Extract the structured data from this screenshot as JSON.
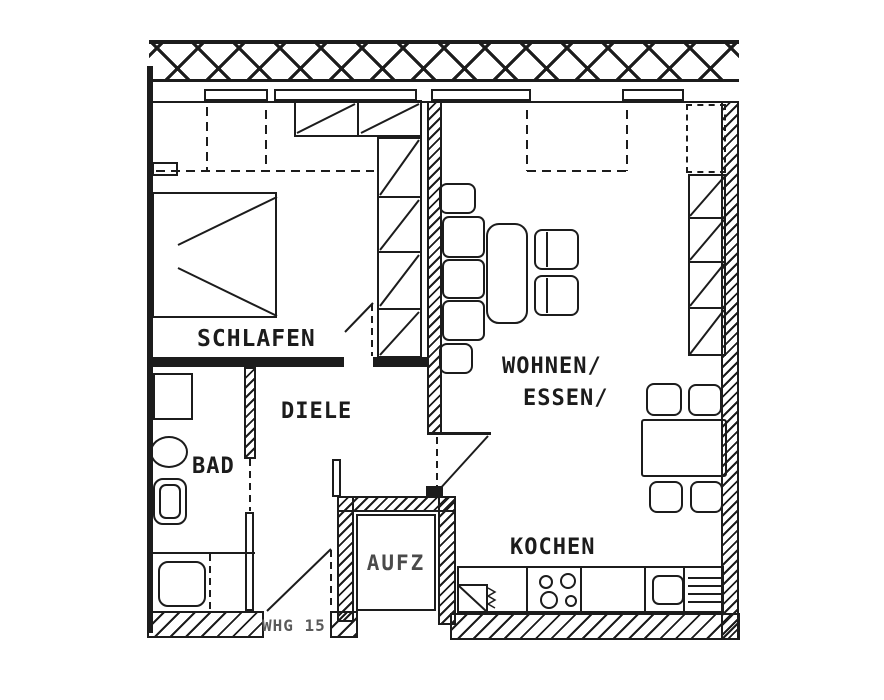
{
  "meta": {
    "kind": "scanned apartment floor plan",
    "unit_label": "WHG 15"
  },
  "colors": {
    "ink": "#1c1c1c",
    "paper": "#ffffff",
    "faded_ink": "#4a4a4a"
  },
  "rooms": {
    "schlafen": {
      "label": "SCHLAFEN"
    },
    "diele": {
      "label": "DIELE"
    },
    "bad": {
      "label": "BAD"
    },
    "wohnen_essen": {
      "label_line1": "WOHNEN/",
      "label_line2": "ESSEN/"
    },
    "kochen": {
      "label": "KOCHEN"
    },
    "aufzug": {
      "label": "AUFZ"
    },
    "entry": {
      "label": "WHG 15"
    }
  }
}
